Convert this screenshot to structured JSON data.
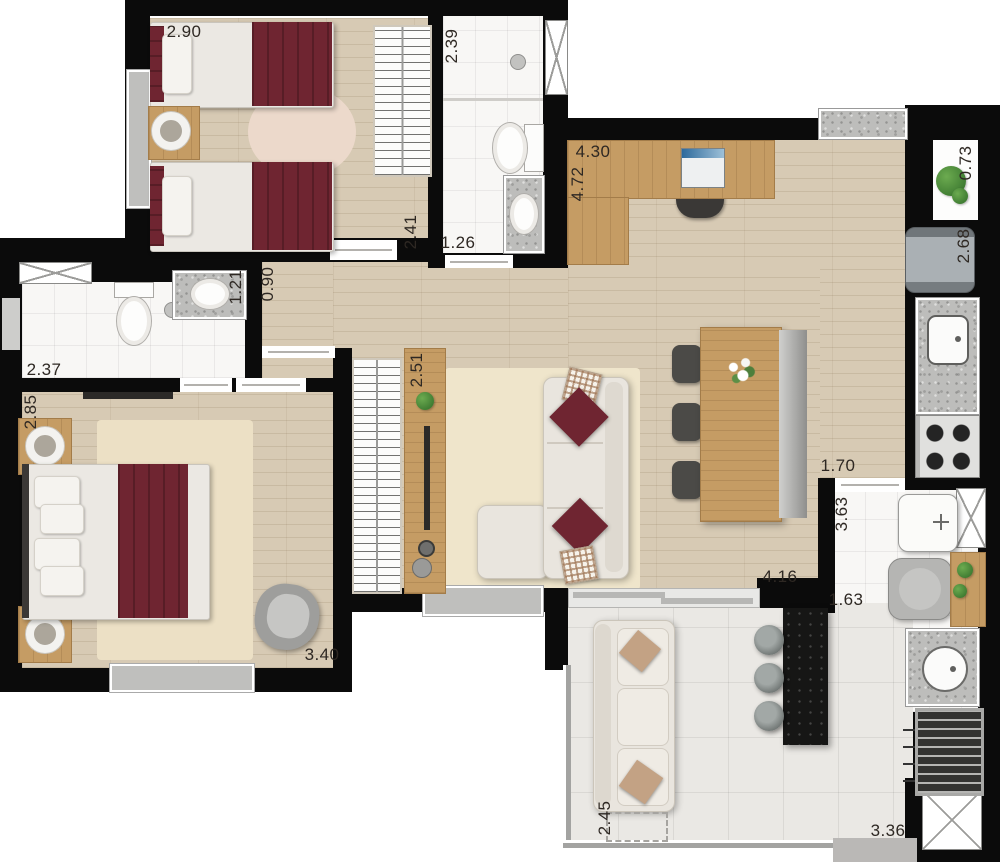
{
  "labels": {
    "bedroom1_width": "2.90",
    "bedroom1_depth": "2.41",
    "bath1_depth": "2.39",
    "bath1_width": "1.26",
    "desk_wall": "4.30",
    "desk_length": "4.72",
    "planter_width": "0.73",
    "fridge_wall": "2.68",
    "hall_width": "0.90",
    "bath2_width": "1.21",
    "bath2_length": "2.37",
    "master_width": "2.85",
    "master_length": "3.40",
    "media_wall": "2.51",
    "kitchen_opening": "1.70",
    "service_length": "3.63",
    "service_width": "1.63",
    "living_length": "4.16",
    "terrace_depth": "2.45",
    "terrace_length": "3.36"
  }
}
